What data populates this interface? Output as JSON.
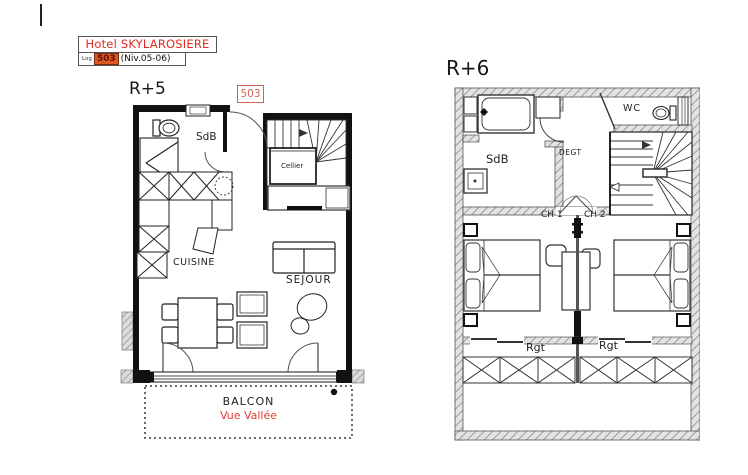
{
  "title_block": {
    "hotel_name": "Hotel SKYLAROSIERE",
    "log_label": "Log",
    "unit_number": "503",
    "level": "(Niv.05-06)"
  },
  "floor_r5": {
    "title": "R+5",
    "unit_tag": "503",
    "rooms": {
      "sdb": "SdB",
      "cellier": "Cellier",
      "cuisine": "CUISINE",
      "sejour": "SEJOUR"
    },
    "balcony": {
      "name": "BALCON",
      "view": "Vue Vallée"
    }
  },
  "floor_r6": {
    "title": "R+6",
    "rooms": {
      "sdb": "SdB",
      "wc": "WC",
      "degt": "DEGT",
      "ch1": "CH 1",
      "ch2": "CH 2",
      "rgt_left": "Rgt",
      "rgt_right": "Rgt"
    }
  },
  "colors": {
    "title_red": "#e02a1f",
    "unit_badge_bg": "#dd5a1f",
    "unit_badge_text": "#5d120a",
    "unit_tag_red": "#cf6459",
    "view_label_red": "#e03b30",
    "wall_black": "#111111",
    "wall_hatch_gray": "#8a8a8a"
  }
}
